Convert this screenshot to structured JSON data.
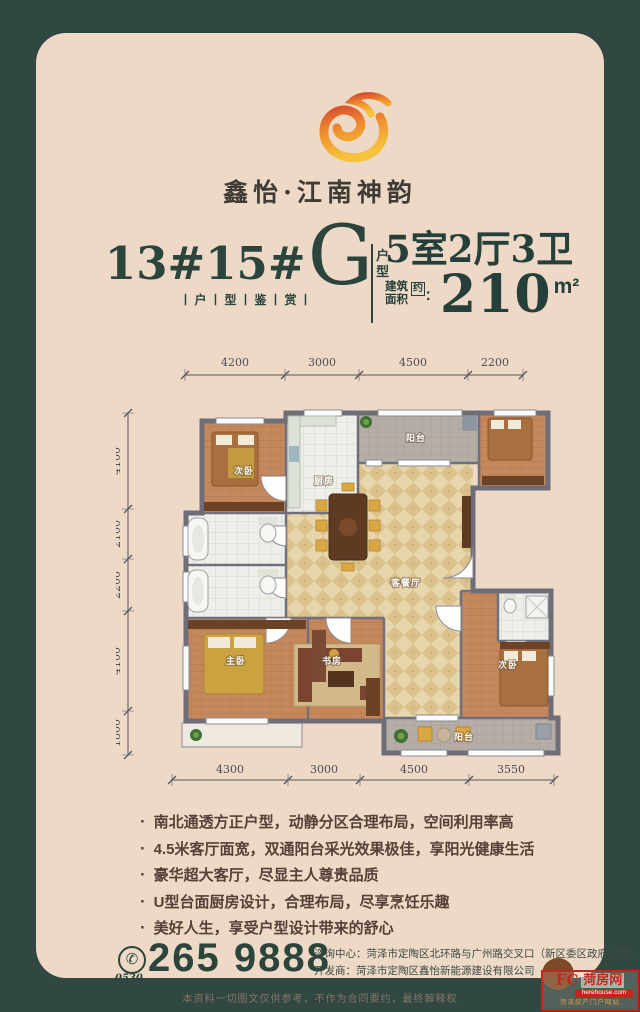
{
  "brand": {
    "name": "鑫怡·江南神韵"
  },
  "title": {
    "block_numbers": "13#15#",
    "letter": "G",
    "letter_suffix_1": "户",
    "letter_suffix_2": "型",
    "subtitle": "丨户丨型丨鉴丨赏丨"
  },
  "spec": {
    "layout": "5室2厅3卫",
    "area_label_line1": "建筑",
    "area_label_line2": "面积",
    "area_approx": "约",
    "area_colon": "：",
    "area_value": "210",
    "area_unit": "m²"
  },
  "floor_plan": {
    "dims_top": [
      "4200",
      "3000",
      "4500",
      "2200"
    ],
    "dims_left": [
      "4100",
      "2100",
      "2200",
      "4100",
      "1800"
    ],
    "dims_bottom": [
      "4300",
      "3000",
      "4500",
      "3550"
    ],
    "rooms": {
      "bedroom_top_left": "次卧",
      "kitchen": "厨房",
      "balcony_top": "阳台",
      "living_dining": "客餐厅",
      "master_bedroom": "主卧",
      "study": "书房",
      "bedroom_bottom_right": "次卧",
      "balcony_bottom": "阳台"
    }
  },
  "features": [
    "南北通透方正户型，动静分区合理布局，空间利用率高",
    "4.5米客厅面宽，双通阳台采光效果极佳，享阳光健康生活",
    "豪华超大客厅，尽显主人尊贵品质",
    "U型台面厨房设计，合理布局，尽享烹饪乐趣",
    "美好人生，享受户型设计带来的舒心"
  ],
  "contact": {
    "area_code": "0530",
    "phone_number": "265 9888",
    "consult_line": "咨询中心：菏泽市定陶区北环路与广州路交叉口（新区委区政府对面）",
    "developer_line": "开发商：菏泽市定陶区鑫怡新能源建设有限公司"
  },
  "disclaimer": "本资料一切图文仅供参考，不作为合同要约，最终解释权",
  "watermark": {
    "logo": "FC",
    "site_name": "菏房网",
    "domain": "herehouse.com",
    "tagline": "菏泽房产门户网站"
  },
  "ui": {
    "bullet": "·",
    "phone_icon": "✆"
  },
  "colors": {
    "background": "#314741",
    "card": "#eed8c6",
    "ink_green": "#2b453d",
    "feature_text": "#564038",
    "logo_red": "#d84f2f",
    "logo_gold": "#f6c33d",
    "watermark_red": "#c2271d"
  }
}
